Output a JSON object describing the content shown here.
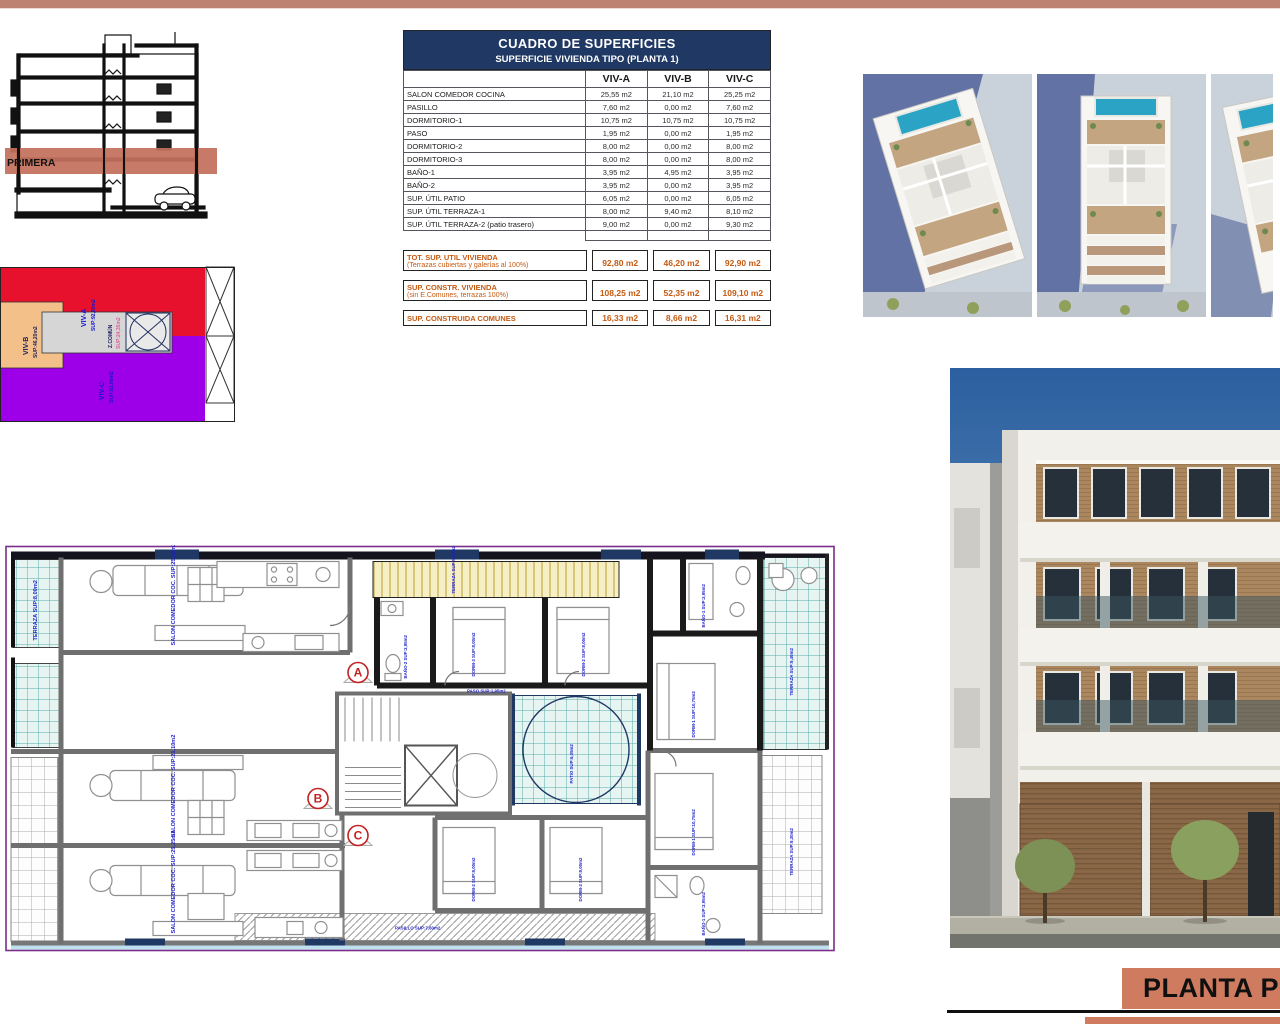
{
  "page": {
    "planta_title": "PLANTA P"
  },
  "section_drawing": {
    "band_label": "PRIMERA"
  },
  "key_plan": {
    "viv_a": {
      "name": "VIV-A",
      "sup": "SUP:92,80m2"
    },
    "viv_b": {
      "name": "VIV-B",
      "sup": "SUP:46,20m2"
    },
    "viv_c": {
      "name": "VIV-C",
      "sup": "SUP:92,90m2"
    },
    "z_comun": {
      "name": "Z.COMÚN",
      "sup": "SUP:24,35m2"
    }
  },
  "table": {
    "title": "CUADRO DE SUPERFICIES",
    "subtitle": "SUPERFICIE VIVIENDA TIPO  (PLANTA 1)",
    "columns": [
      "VIV-A",
      "VIV-B",
      "VIV-C"
    ],
    "rows": [
      [
        "SALON COMEDOR COCINA",
        "25,55 m2",
        "21,10 m2",
        "25,25 m2"
      ],
      [
        "PASILLO",
        "7,60 m2",
        "0,00 m2",
        "7,60 m2"
      ],
      [
        "DORMITORIO-1",
        "10,75 m2",
        "10,75 m2",
        "10,75 m2"
      ],
      [
        "PASO",
        "1,95 m2",
        "0,00 m2",
        "1,95 m2"
      ],
      [
        "DORMITORIO-2",
        "8,00 m2",
        "0,00 m2",
        "8,00 m2"
      ],
      [
        "DORMITORIO-3",
        "8,00 m2",
        "0,00 m2",
        "8,00 m2"
      ],
      [
        "BAÑO-1",
        "3,95 m2",
        "4,95 m2",
        "3,95 m2"
      ],
      [
        "BAÑO-2",
        "3,95 m2",
        "0,00 m2",
        "3,95 m2"
      ],
      [
        "SUP. ÚTIL PATIO",
        "6,05 m2",
        "0,00 m2",
        "6,05 m2"
      ],
      [
        "SUP. ÚTIL TERRAZA-1",
        "8,00 m2",
        "9,40 m2",
        "8,10 m2"
      ],
      [
        "SUP. ÚTIL TERRAZA-2 (patio trasero)",
        "9,00 m2",
        "0,00 m2",
        "9,30 m2"
      ]
    ],
    "totals": [
      {
        "label": "TOT. SUP. UTIL VIVIENDA",
        "sub": "(Terrazas cubiertas y galerías al 100%)",
        "values": [
          "92,80 m2",
          "46,20 m2",
          "92,90 m2"
        ]
      },
      {
        "label": "SUP. CONSTR. VIVIENDA",
        "sub": "(sin E.Comunes, terrazas 100%)",
        "values": [
          "108,25 m2",
          "52,35 m2",
          "109,10 m2"
        ]
      },
      {
        "label": "SUP. CONSTRUIDA COMUNES",
        "sub": "",
        "values": [
          "16,33 m2",
          "8,66 m2",
          "16,31 m2"
        ]
      }
    ]
  },
  "floor_plan": {
    "markers": [
      "A",
      "B",
      "C"
    ],
    "labels": [
      "SALON COMEDOR COC. SUP:25,55m2",
      "TERRAZA SUP:8,00m2",
      "BAÑO-2 SUP:3,95m2",
      "DORM-3 SUP:8,00m2",
      "DORM-2 SUP:8,00m2",
      "TERRAZA SUP:9,00m2",
      "BAÑO-1 SUP:3,95m2",
      "DORM-1 SUP:10,75m2",
      "TERRAZA SUP:9,40m2",
      "PATIO SUP:6,05m2",
      "SALON COMEDOR COC. SUP:21,10m2",
      "SALON COMEDOR COC. SUP:25,25m2",
      "DORM-2 SUP:8,00m2",
      "DORM-3 SUP:8,00m2",
      "DORM-1 SUP:10,75m2",
      "BAÑO-1 SUP:3,95m2",
      "TERRAZA SUP:9,30m2",
      "PASILLO SUP:7,60m2",
      "PASO SUP:1,95m2"
    ]
  }
}
